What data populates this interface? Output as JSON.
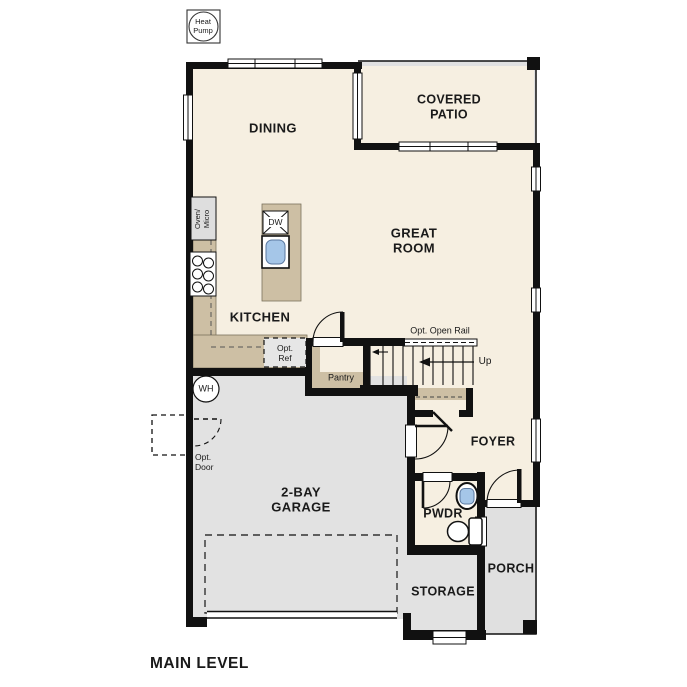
{
  "title": "MAIN LEVEL",
  "labels": {
    "heat_pump": "Heat\nPump",
    "covered_patio": "COVERED\nPATIO",
    "dining": "DINING",
    "great_room": "GREAT\nROOM",
    "kitchen": "KITCHEN",
    "oven_micro": "Oven/\nMicro",
    "dw": "DW",
    "opt_ref": "Opt.\nRef",
    "pantry": "Pantry",
    "opt_open_rail": "Opt. Open Rail",
    "up": "Up",
    "wh": "WH",
    "opt_door": "Opt.\nDoor",
    "garage": "2-BAY\nGARAGE",
    "foyer": "FOYER",
    "pwdr": "PWDR",
    "porch": "PORCH",
    "storage": "STORAGE"
  },
  "colors": {
    "wall": "#111111",
    "floor_interior": "#f6efe1",
    "floor_exterior": "#e0e0e0",
    "counter_tan": "#cdbfa4",
    "sink_blue": "#a5c6e8",
    "appliance_gray": "#dedede",
    "text": "#1a1a1a",
    "background": "#ffffff"
  }
}
